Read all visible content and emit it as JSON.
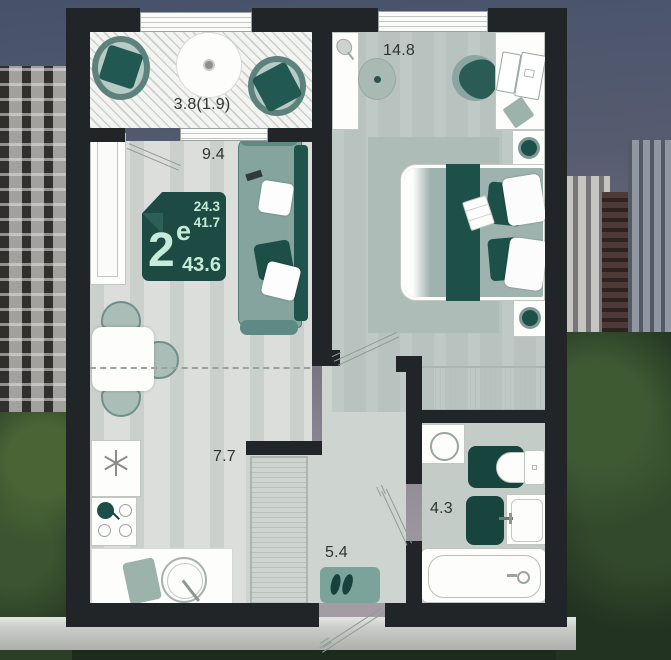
{
  "badge": {
    "living_area": "24.3",
    "area_no_balcony": "41.7",
    "rooms_count": "2",
    "type_letter": "е",
    "total_area": "43.6"
  },
  "rooms": {
    "balcony_label": "3.8(1.9)",
    "living_label": "9.4",
    "bedroom_label": "14.8",
    "kitchen_label": "7.7",
    "hallway_label": "5.4",
    "bathroom_label": "4.3"
  },
  "colors": {
    "wall": "#222528",
    "accent_teal": "#1d4a42",
    "accent_teal_bright": "#1d5048",
    "sage": "#9db3ad",
    "badge_text": "#c5ecd9",
    "floor_light": "#dbdeda",
    "floor_bedroom": "#b8c3bf",
    "floor_bathroom": "#c4ccc8"
  }
}
